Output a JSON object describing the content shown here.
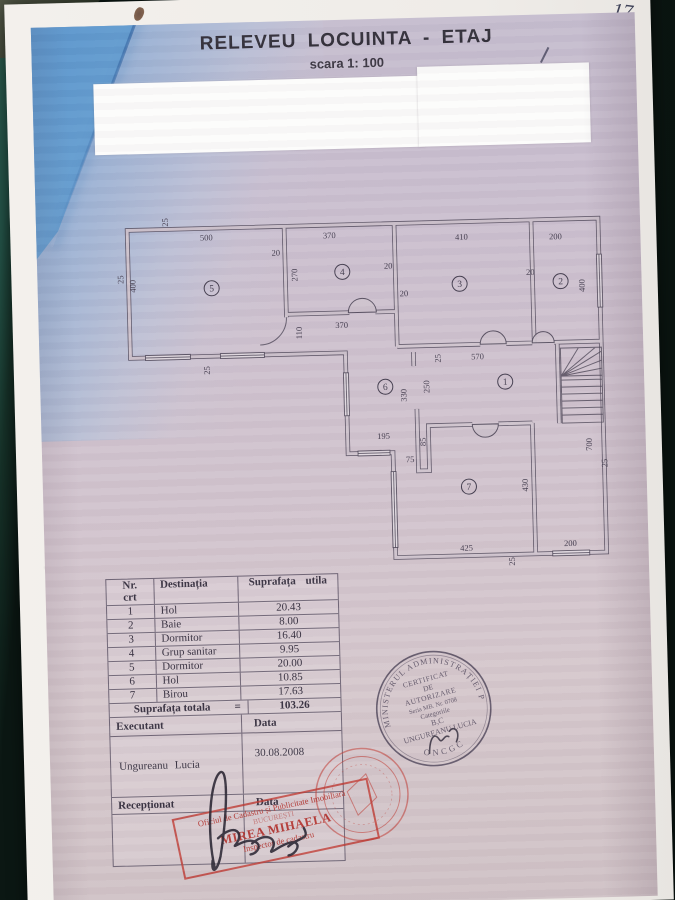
{
  "header": {
    "title": "RELEVEU LOCUINTA - ETAJ",
    "scale": "scara 1: 100",
    "page_number": "17"
  },
  "plan": {
    "rooms": [
      {
        "n": "5",
        "x": 216,
        "y": 289
      },
      {
        "n": "4",
        "x": 347,
        "y": 276
      },
      {
        "n": "3",
        "x": 464,
        "y": 291
      },
      {
        "n": "2",
        "x": 565,
        "y": 291
      },
      {
        "n": "6",
        "x": 387,
        "y": 392
      },
      {
        "n": "1",
        "x": 507,
        "y": 390
      },
      {
        "n": "7",
        "x": 468,
        "y": 494
      }
    ],
    "dims": [
      {
        "t": "500",
        "x": 212,
        "y": 241,
        "v": 0
      },
      {
        "t": "25",
        "x": 174,
        "y": 222,
        "v": 1
      },
      {
        "t": "25",
        "x": 128,
        "y": 278,
        "v": 1
      },
      {
        "t": "400",
        "x": 140,
        "y": 285,
        "v": 1
      },
      {
        "t": "20",
        "x": 281,
        "y": 258,
        "v": 0
      },
      {
        "t": "370",
        "x": 335,
        "y": 242,
        "v": 0
      },
      {
        "t": "270",
        "x": 302,
        "y": 278,
        "v": 1
      },
      {
        "t": "20",
        "x": 393,
        "y": 274,
        "v": 0
      },
      {
        "t": "20",
        "x": 408,
        "y": 302,
        "v": 0
      },
      {
        "t": "410",
        "x": 467,
        "y": 247,
        "v": 0
      },
      {
        "t": "200",
        "x": 561,
        "y": 249,
        "v": 0
      },
      {
        "t": "20",
        "x": 535,
        "y": 284,
        "v": 0
      },
      {
        "t": "400",
        "x": 589,
        "y": 296,
        "v": 1
      },
      {
        "t": "110",
        "x": 305,
        "y": 336,
        "v": 1
      },
      {
        "t": "370",
        "x": 345,
        "y": 332,
        "v": 0
      },
      {
        "t": "25",
        "x": 443,
        "y": 365,
        "v": 1
      },
      {
        "t": "570",
        "x": 480,
        "y": 367,
        "v": 0
      },
      {
        "t": "330",
        "x": 408,
        "y": 401,
        "v": 1
      },
      {
        "t": "250",
        "x": 431,
        "y": 393,
        "v": 1
      },
      {
        "t": "195",
        "x": 384,
        "y": 444,
        "v": 0
      },
      {
        "t": "85",
        "x": 426,
        "y": 448,
        "v": 1
      },
      {
        "t": "75",
        "x": 410,
        "y": 468,
        "v": 0
      },
      {
        "t": "430",
        "x": 527,
        "y": 494,
        "v": 1
      },
      {
        "t": "425",
        "x": 464,
        "y": 558,
        "v": 0
      },
      {
        "t": "200",
        "x": 568,
        "y": 556,
        "v": 0
      },
      {
        "t": "700",
        "x": 592,
        "y": 455,
        "v": 1
      },
      {
        "t": "25",
        "x": 607,
        "y": 474,
        "v": 1
      },
      {
        "t": "25",
        "x": 212,
        "y": 371,
        "v": 1
      },
      {
        "t": "25",
        "x": 512,
        "y": 570,
        "v": 1
      }
    ]
  },
  "table": {
    "header_col1a": "Nr.",
    "header_col1b": "crt",
    "header_col2": "Destinația",
    "header_col3": "Suprafața utila",
    "rows": [
      {
        "nr": "1",
        "dest": "Hol",
        "area": "20.43"
      },
      {
        "nr": "2",
        "dest": "Baie",
        "area": "8.00"
      },
      {
        "nr": "3",
        "dest": "Dormitor",
        "area": "16.40"
      },
      {
        "nr": "4",
        "dest": "Grup sanitar",
        "area": "9.95"
      },
      {
        "nr": "5",
        "dest": "Dormitor",
        "area": "20.00"
      },
      {
        "nr": "6",
        "dest": "Hol",
        "area": "10.85"
      },
      {
        "nr": "7",
        "dest": "Birou",
        "area": "17.63"
      }
    ],
    "total_label": "Suprafața totala",
    "total_eq": "=",
    "total_value": "103.26",
    "executant_label": "Executant",
    "data_label": "Data",
    "executant_name": "Ungureanu Lucia",
    "executant_date": "30.08.2008",
    "receptionat_label": "Recepționat",
    "receptionat_data_label": "Data"
  },
  "stamps": {
    "round_black": {
      "arc_top": "MINISTERUL ADMINISTRAȚIEI PUBLICE",
      "arc_bottom": "ONCGC",
      "lines": [
        "CERTIFICAT",
        "DE",
        "AUTORIZARE",
        "Seria MB. Nr. 0708",
        "Categoriile",
        "B,C",
        "UNGUREANU LUCIA"
      ]
    },
    "rect_red": {
      "line1": "Oficiul de Cadastru și Publicitate Imobiliară",
      "line2": "BUCUREȘTI",
      "line3": "MIREA MIHAELA",
      "line4": "Inspector de cadastru"
    }
  },
  "colors": {
    "stamp_red": "#bf3a32",
    "ink": "#3a3443",
    "backdrop_green": "#235146",
    "blue_wash": "#5792ca"
  }
}
